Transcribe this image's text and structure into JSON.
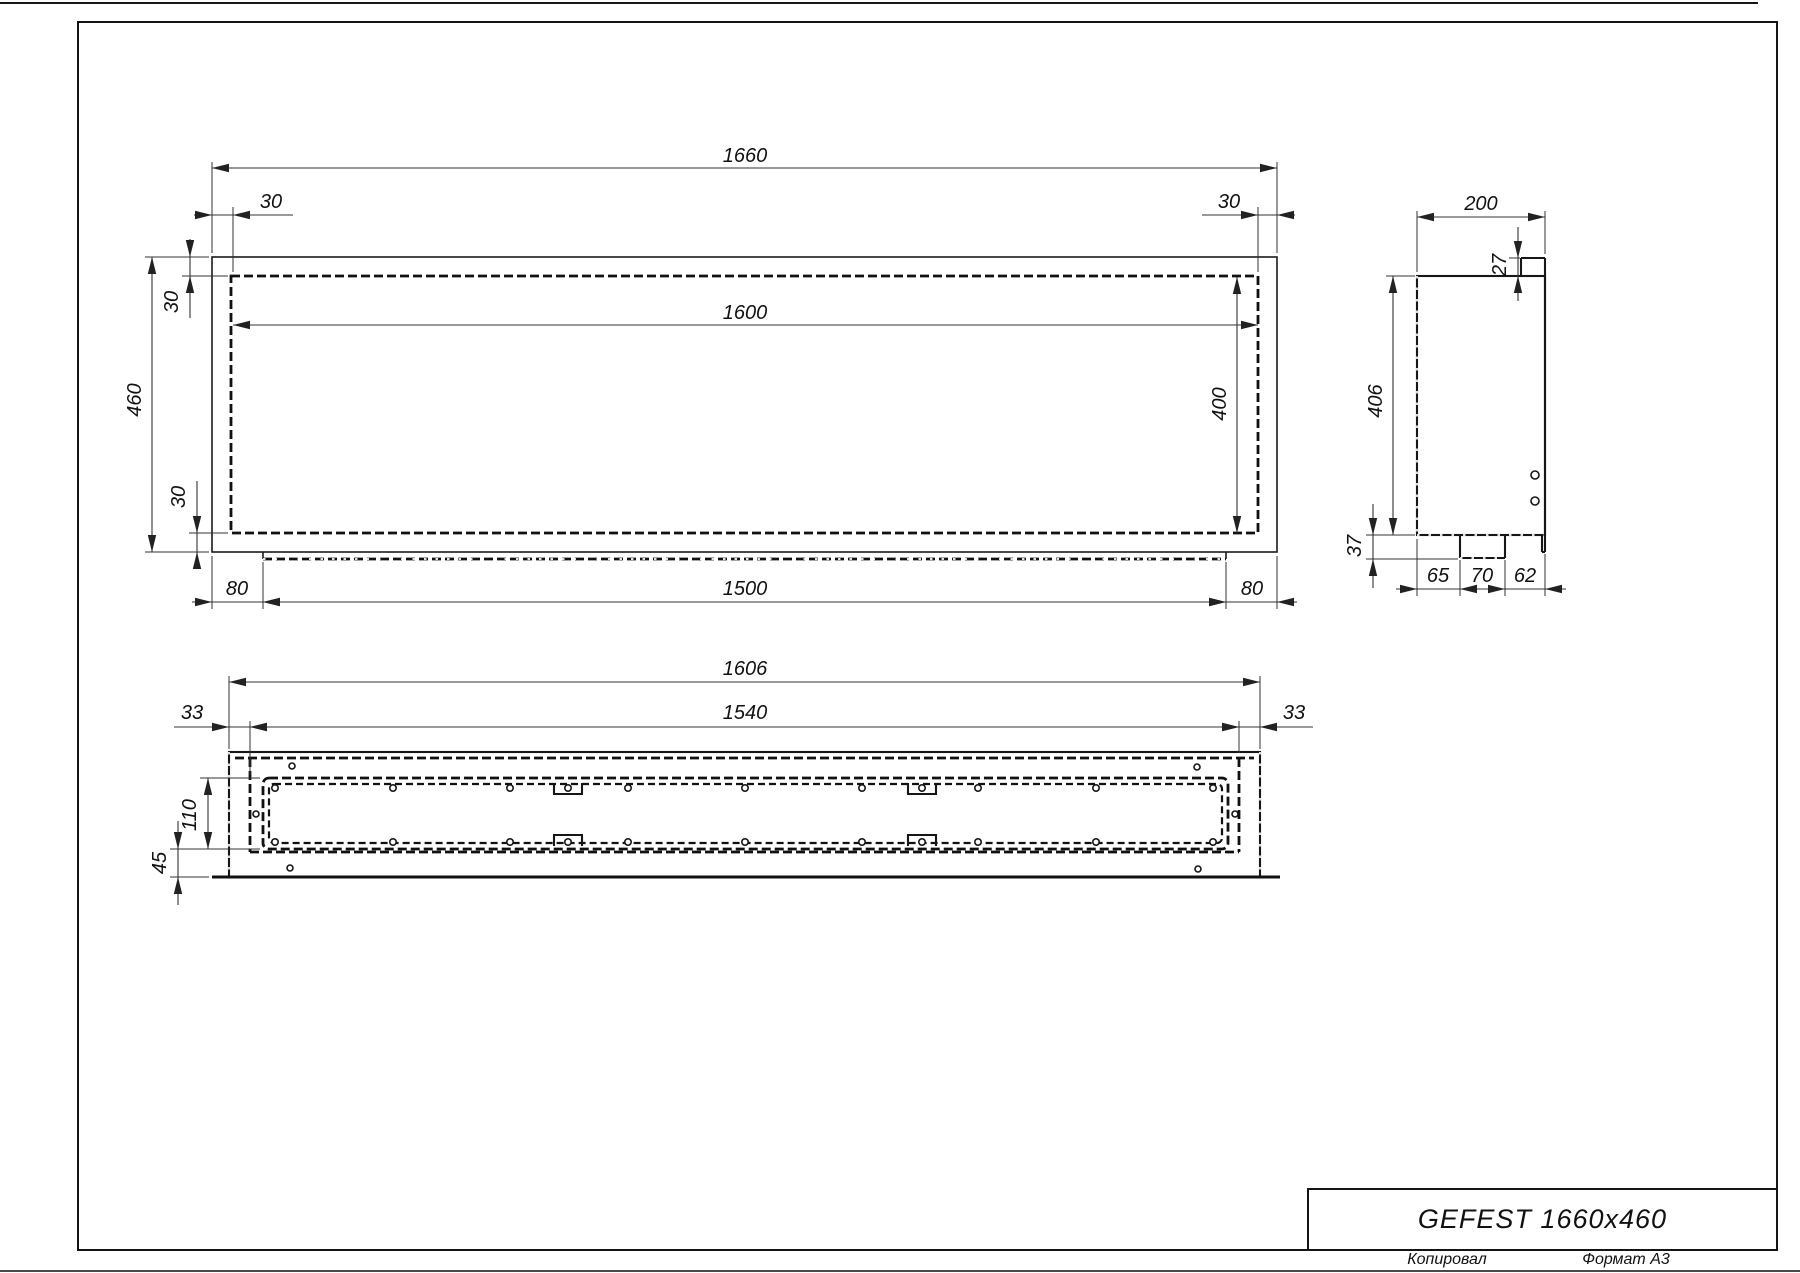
{
  "title_block": {
    "title": "GEFEST 1660x460",
    "copied_label": "Копировал",
    "format_label": "Формат А3"
  },
  "views": {
    "front": {
      "dims": {
        "width": "1660",
        "opening_width": "1600",
        "height": "460",
        "opening_height": "400",
        "margin_top_left": "30",
        "margin_top_right": "30",
        "margin_left": "30",
        "margin_bottom": "30",
        "tray_offset_left": "80",
        "tray_width": "1500",
        "tray_offset_right": "80"
      }
    },
    "side": {
      "dims": {
        "depth": "200",
        "flange": "27",
        "height": "406",
        "bottom_drop": "37",
        "seg_left": "65",
        "seg_mid": "70",
        "seg_right": "62"
      }
    },
    "bottom": {
      "dims": {
        "width": "1606",
        "side_left": "33",
        "inner_width": "1540",
        "side_right": "33",
        "slot_depth": "110",
        "front_gap": "45"
      }
    }
  }
}
